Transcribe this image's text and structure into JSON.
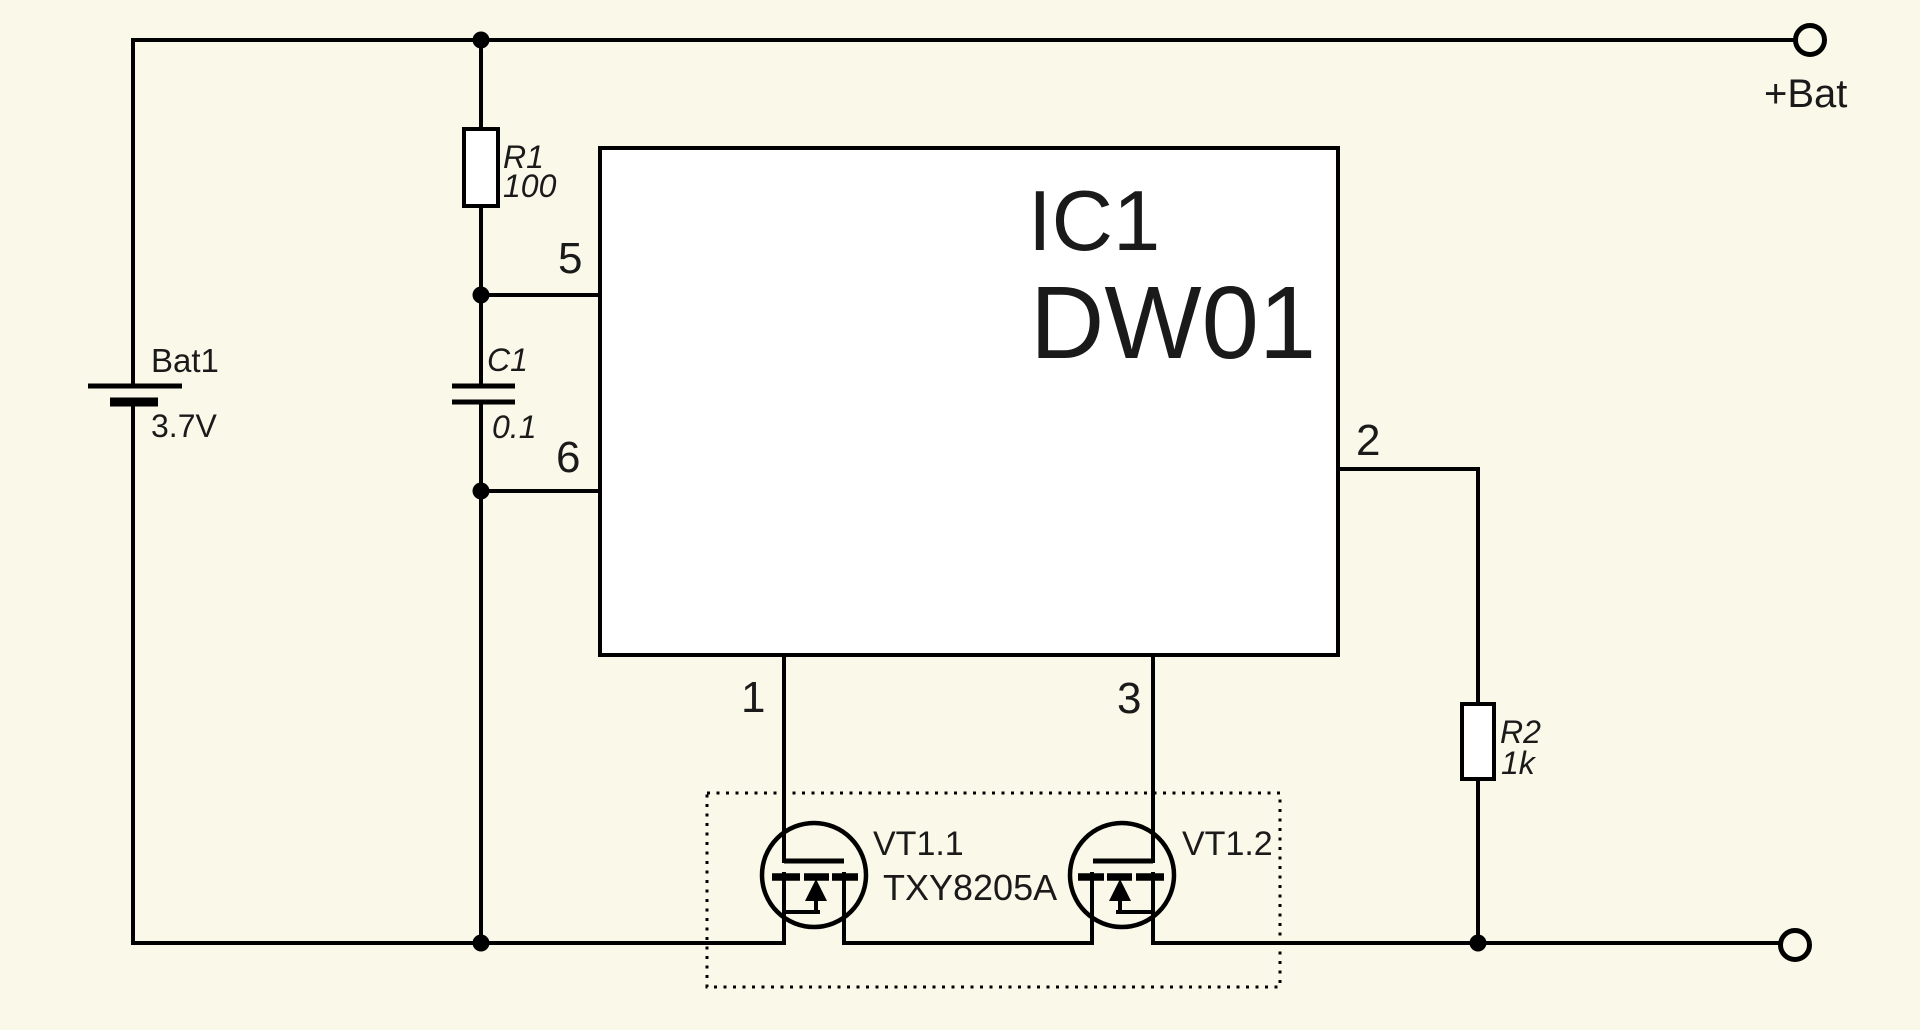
{
  "colors": {
    "background": "#FAF8E8",
    "line": "#000000",
    "component_fill": "#FFFFFF"
  },
  "battery": {
    "ref": "Bat1",
    "voltage": "3.7V"
  },
  "resistor_r1": {
    "ref": "R1",
    "value": "100"
  },
  "capacitor_c1": {
    "ref": "C1",
    "value": "0.1"
  },
  "ic": {
    "ref": "IC1",
    "part": "DW01"
  },
  "resistor_r2": {
    "ref": "R2",
    "value": "1k"
  },
  "mosfet_pair": {
    "left_ref": "VT1.1",
    "right_ref": "VT1.2",
    "part": "TXY8205A"
  },
  "pins": {
    "pin1": "1",
    "pin2": "2",
    "pin3": "3",
    "pin5": "5",
    "pin6": "6"
  },
  "terminals": {
    "positive": "+Bat"
  }
}
